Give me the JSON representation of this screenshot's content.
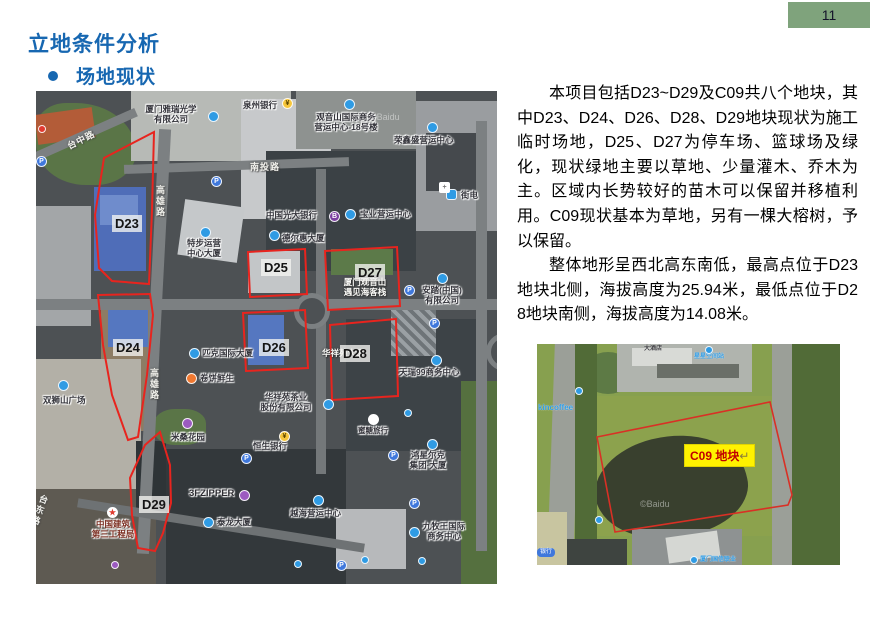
{
  "page": {
    "number": "11"
  },
  "title": "立地条件分析",
  "subtitle": "场地现状",
  "paragraphs": {
    "p1": "本项目包括D23~D29及C09共八个地块，其中D23、D24、D26、D28、D29地块现状为施工临时场地，D25、D27为停车场、篮球场及绿化，现状绿地主要以草地、少量灌木、乔木为主。区域内长势较好的苗木可以保留并移植利用。C09现状基本为草地，另有一棵大榕树，予以保留。",
    "p2": "整体地形呈西北高东南低，最高点位于D23地块北侧，海拔高度为25.94米，最低点位于D28地块南侧，海拔高度为14.08米。"
  },
  "icons": {
    "parking": "P",
    "bank": "¥",
    "metro": "B",
    "star": "★",
    "cross": "+"
  },
  "map_main": {
    "watermark": "©Baidu",
    "plots": [
      {
        "id": "D23"
      },
      {
        "id": "D24"
      },
      {
        "id": "D25"
      },
      {
        "id": "D26"
      },
      {
        "id": "D27"
      },
      {
        "id": "D28"
      },
      {
        "id": "D29"
      }
    ],
    "roads": [
      {
        "t": "台中路"
      },
      {
        "t": "高雄路"
      },
      {
        "t": "南投路"
      },
      {
        "t": "高雄路"
      },
      {
        "t": "台东路"
      }
    ],
    "pois": [
      {
        "t": "厦门雅瑞光学\n有限公司"
      },
      {
        "t": "泉州银行"
      },
      {
        "t": "观音山国际商务\n营运中心-18号楼"
      },
      {
        "t": "荣鑫盛营运中心"
      },
      {
        "t": "中国光大银行"
      },
      {
        "t": "宝业营运中心"
      },
      {
        "t": "街电"
      },
      {
        "t": "德尔惠大厦"
      },
      {
        "t": "特步运营\n中心大厦"
      },
      {
        "t": "匹克国际大厦"
      },
      {
        "t": "卷饼鲜生"
      },
      {
        "t": "安踏(中国)\n有限公司"
      },
      {
        "t": "天瑞99商务中心"
      },
      {
        "t": "厦门观音山\n遇见海客栈"
      },
      {
        "t": "华祥苑大厦"
      },
      {
        "t": "华祥苑茶业\n股份有限公司"
      },
      {
        "t": "蜜糖旅行"
      },
      {
        "t": "恒生银行"
      },
      {
        "t": "鸿星尔克\n集团·大厦"
      },
      {
        "t": "越海营运中心"
      },
      {
        "t": "九牧王国际\n商务中心"
      },
      {
        "t": "米桑花园"
      },
      {
        "t": "3FZIPPER"
      },
      {
        "t": "泰龙大厦"
      },
      {
        "t": "中国建筑\n第三工程局"
      },
      {
        "t": "双狮山广场"
      }
    ]
  },
  "map_c09": {
    "watermark": "©Baidu",
    "label": "C09 地块",
    "return_mark": "↵",
    "pois": [
      {
        "t": "kincoffee"
      },
      {
        "t": "大酒店"
      },
      {
        "t": "星星空间站"
      },
      {
        "t": "银行"
      },
      {
        "t": "厦门国信联业"
      }
    ]
  }
}
